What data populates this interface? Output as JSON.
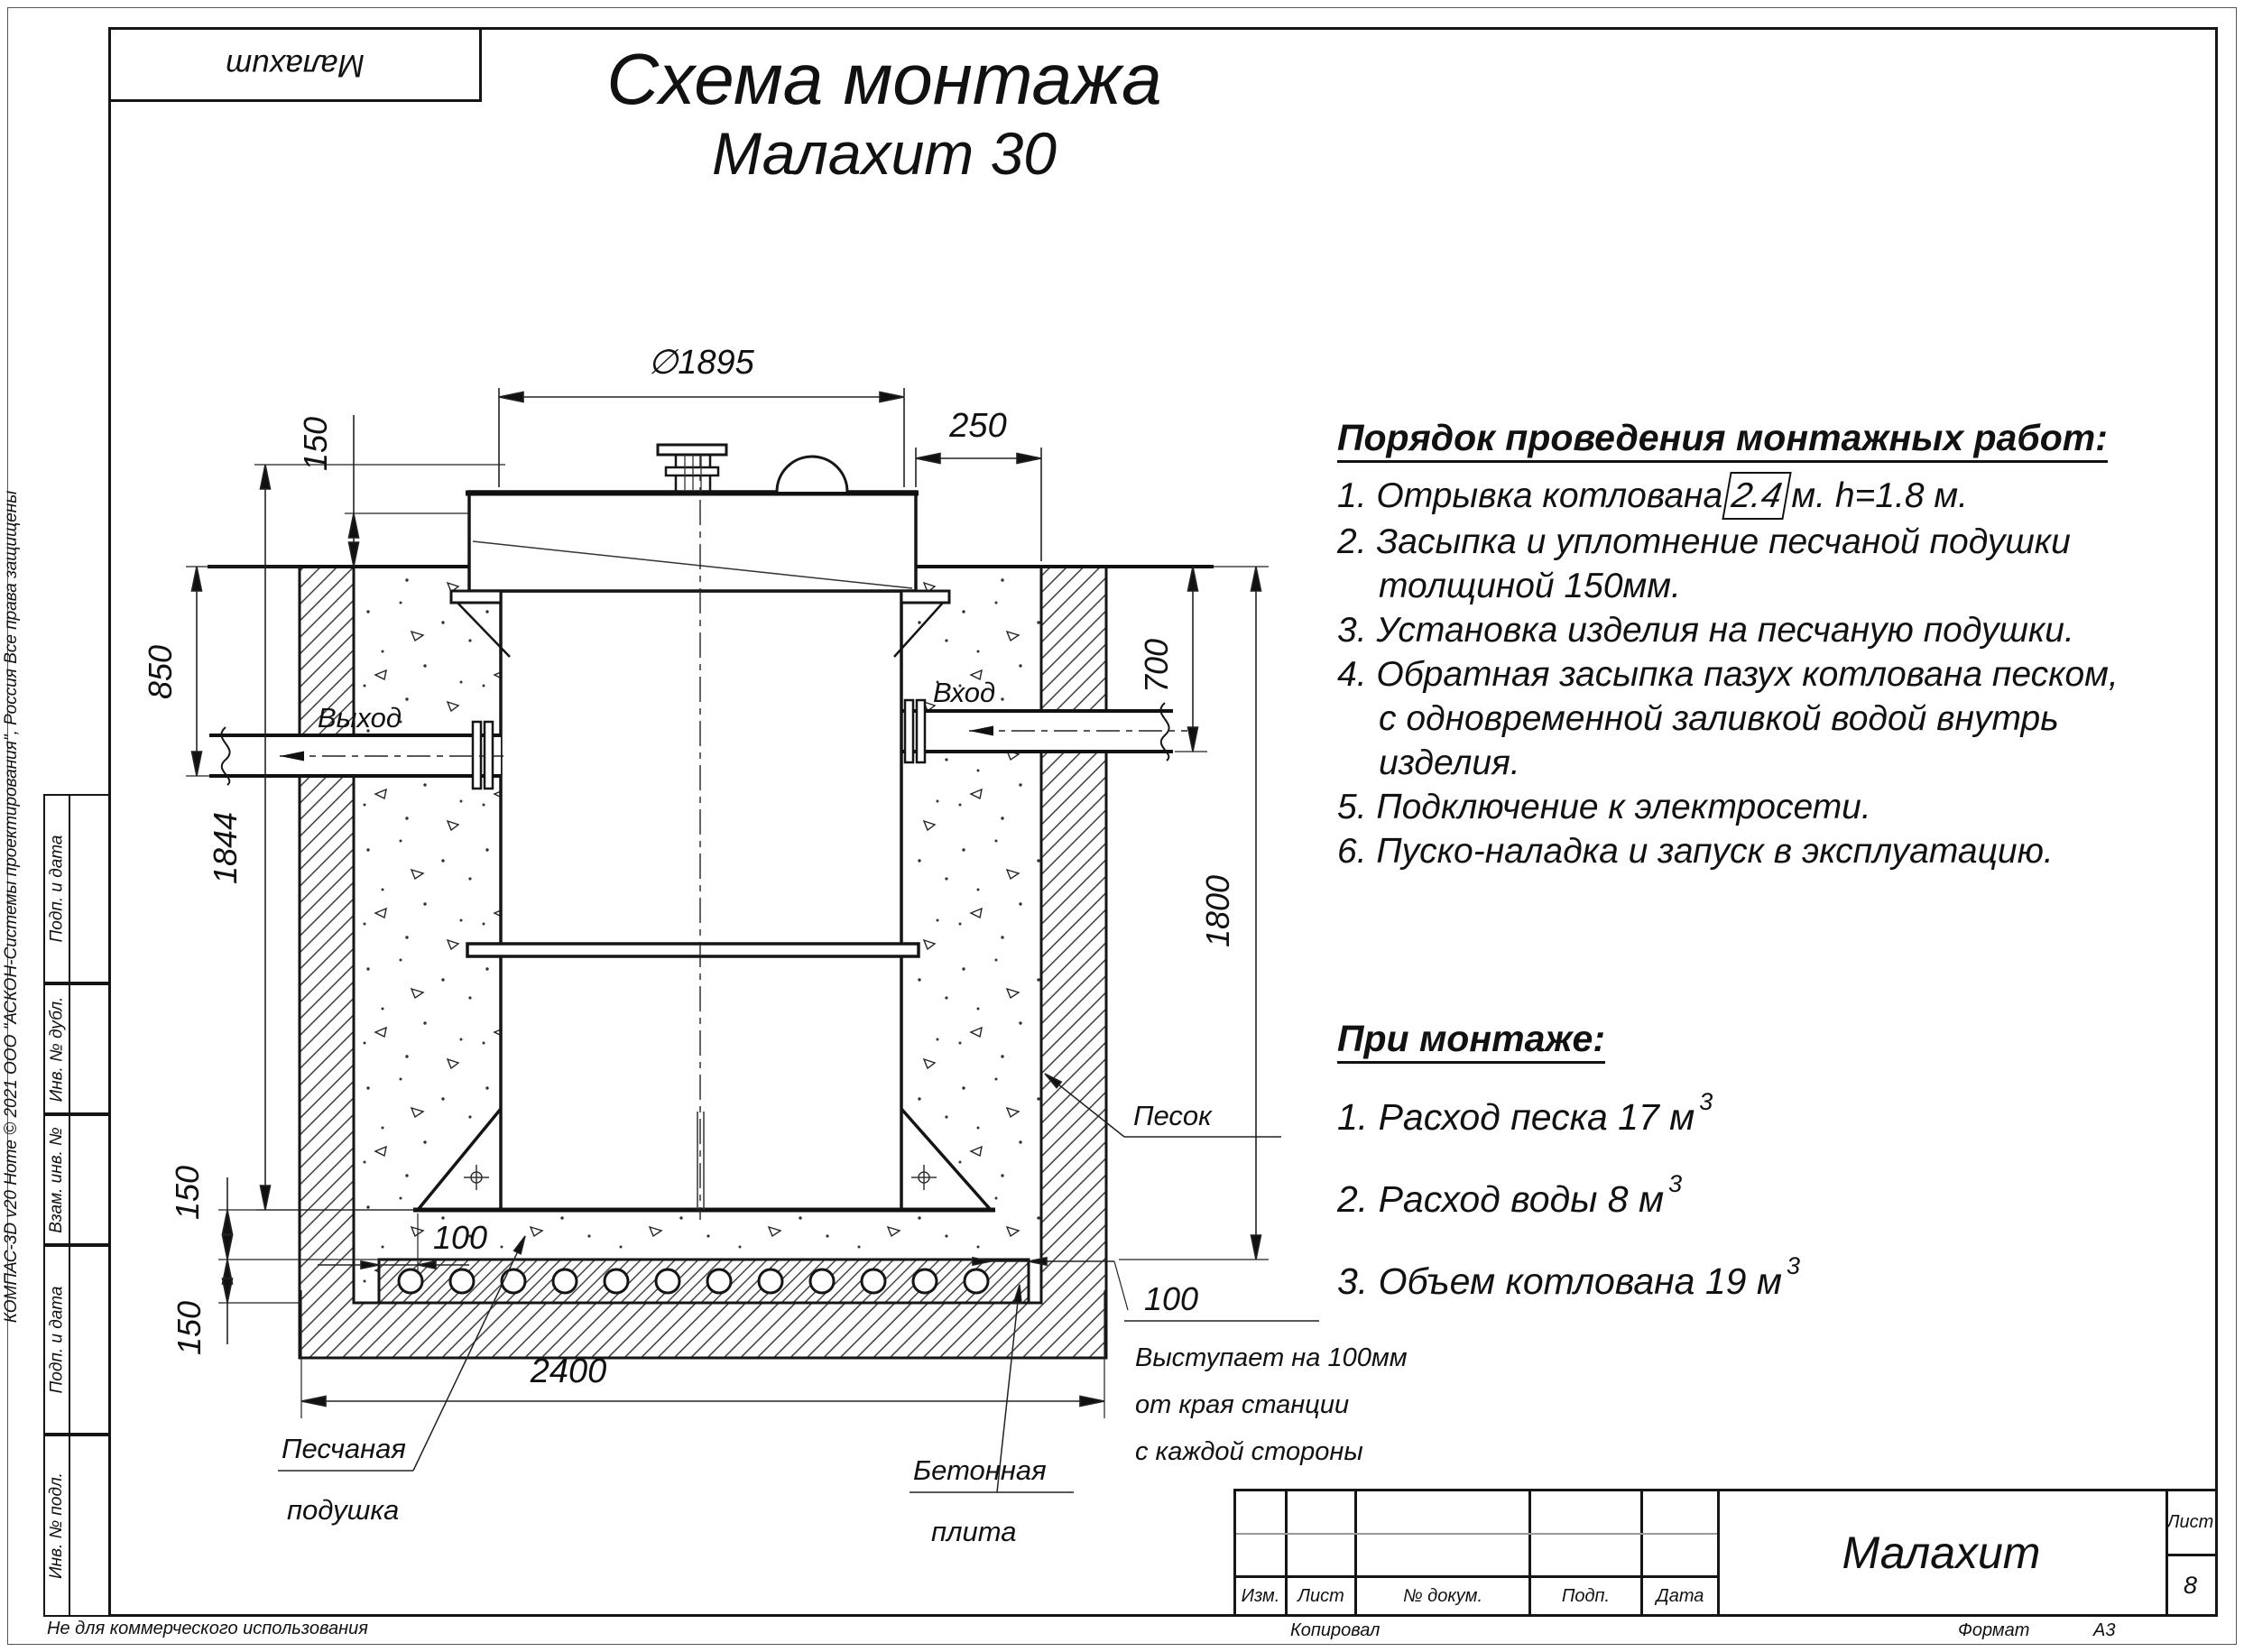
{
  "sheet": {
    "title_line1": "Схема монтажа",
    "title_line2": "Малахит 30",
    "corner_stamp": "Малахит",
    "footer_note": "Не для коммерческого использования",
    "copyright": "КОМПАС-3D v20 Home © 2021 ООО \"АСКОН-Системы проектирования\", Россия Все права защищены"
  },
  "sidebar": {
    "cells": [
      "Подп. и дата",
      "Инв. № дубл.",
      "Взам. инв. №",
      "Подп. и дата",
      "Инв. № подл."
    ]
  },
  "instructions": {
    "heading": "Порядок проведения монтажных работ:",
    "item1_prefix": "1. Отрывка котлована",
    "item1_box": "2.4",
    "item1_suffix": "м. h=1.8 м.",
    "lines": [
      "2. Засыпка и уплотнение песчаной подушки",
      "толщиной 150мм.",
      "3. Установка изделия на песчаную подушки.",
      "4. Обратная засыпка пазух котлована песком,",
      "с одновременной заливкой водой внутрь",
      "изделия.",
      "5. Подключение к электросети.",
      "6. Пуско-наладка и запуск в эксплуатацию."
    ]
  },
  "notes": {
    "heading": "При монтаже:",
    "sup": "3",
    "items": [
      "1. Расход песка 17 м",
      "2. Расход воды 8 м",
      "3. Объем котлована 19 м"
    ]
  },
  "drawing": {
    "dims": {
      "diameter": "∅1895",
      "right_offset": "250",
      "top_embed": "150",
      "outlet_depth": "850",
      "tank_height": "1844",
      "inlet_depth": "700",
      "pit_depth": "1800",
      "cushion": "150",
      "plate": "150",
      "pit_width": "2400",
      "overhang_left": "100",
      "overhang_right": "100"
    },
    "labels": {
      "outlet": "Выход",
      "inlet": "Вход",
      "sand": "Песок",
      "cushion1": "Песчаная",
      "cushion2": "подушка",
      "plate1": "Бетонная",
      "plate2": "плита",
      "note1": "Выступает на 100мм",
      "note2": "от края станции",
      "note3": "с каждой стороны"
    }
  },
  "titleblock": {
    "col_izm": "Изм.",
    "col_list": "Лист",
    "col_doc": "№ докум.",
    "col_podp": "Подп.",
    "col_data": "Дата",
    "doc_name": "Малахит",
    "sheet_label": "Лист",
    "sheet_number": "8",
    "copied": "Копировал",
    "format_label": "Формат",
    "format_value": "А3"
  }
}
